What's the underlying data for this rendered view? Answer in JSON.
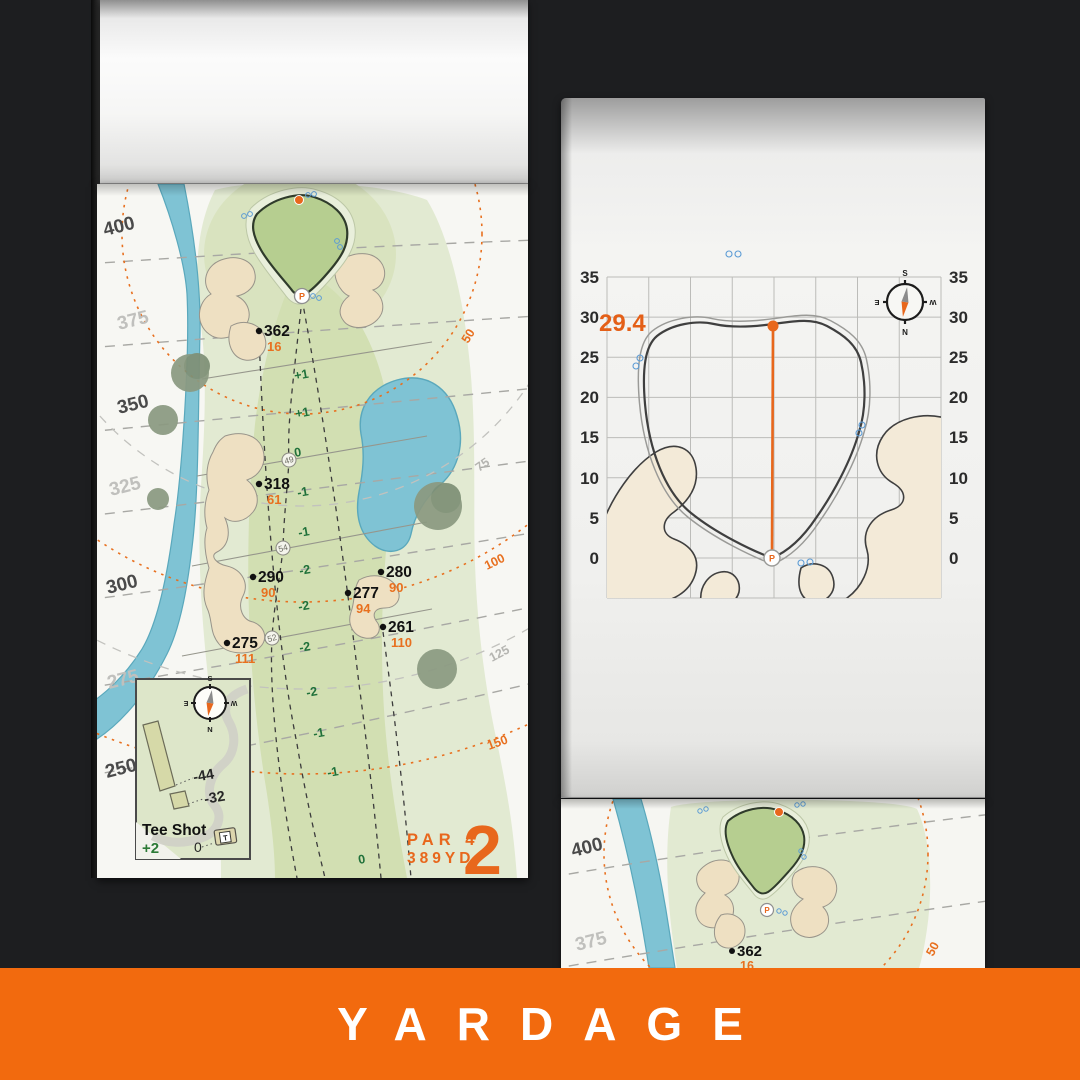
{
  "banner": {
    "label": "YARDAGE"
  },
  "colors": {
    "accent_orange": "#e8671c",
    "banner_orange": "#f26a0e",
    "water_blue": "#7fc3d4",
    "putting_green": "#b6ce90",
    "fairway_green": "#d2dfb2",
    "bunker_sand": "#eee0c2",
    "slope_green": "#20713a"
  },
  "left_page": {
    "hole_number": "2",
    "par_label": "PAR 4",
    "yardage_label": "389YD",
    "pin_label": "P",
    "distance_labels": [
      {
        "text": "400",
        "tone": "dark"
      },
      {
        "text": "375",
        "tone": "light"
      },
      {
        "text": "350",
        "tone": "dark"
      },
      {
        "text": "325",
        "tone": "light"
      },
      {
        "text": "300",
        "tone": "dark"
      },
      {
        "text": "275",
        "tone": "light"
      },
      {
        "text": "250",
        "tone": "dark"
      }
    ],
    "arc_labels": [
      {
        "text": "50",
        "tone": "orange"
      },
      {
        "text": "75",
        "tone": "gray"
      },
      {
        "text": "100",
        "tone": "orange"
      },
      {
        "text": "125",
        "tone": "gray"
      },
      {
        "text": "150",
        "tone": "orange"
      }
    ],
    "markers": [
      {
        "carry": "362",
        "to_pin": "16"
      },
      {
        "carry": "318",
        "to_pin": "61"
      },
      {
        "carry": "290",
        "to_pin": "90"
      },
      {
        "carry": "275",
        "to_pin": "111"
      },
      {
        "carry": "280",
        "to_pin": "90"
      },
      {
        "carry": "277",
        "to_pin": "94"
      },
      {
        "carry": "261",
        "to_pin": "110"
      }
    ],
    "slope_numbers": [
      "+1",
      "+1",
      "0",
      "-1",
      "-1",
      "-2",
      "-2",
      "-2",
      "-2",
      "-1",
      "-1",
      "0"
    ],
    "circled_numbers": [
      "49",
      "54",
      "52"
    ],
    "compass": {
      "top": "S",
      "bottom": "N",
      "left": "E",
      "right": "W"
    },
    "tee_inset": {
      "title": "Tee Shot",
      "score": "+2",
      "origin": "0",
      "offset_long": "-44",
      "offset_short": "-32",
      "tee_marker": "T"
    }
  },
  "right_page": {
    "green_depth": "29.4",
    "pin_label": "P",
    "axis_ticks_left": [
      "35",
      "30",
      "25",
      "20",
      "15",
      "10",
      "5",
      "0"
    ],
    "axis_ticks_right": [
      "35",
      "30",
      "25",
      "20",
      "15",
      "10",
      "5",
      "0"
    ],
    "compass": {
      "top": "S",
      "bottom": "N",
      "left": "E",
      "right": "W"
    }
  },
  "preview_page": {
    "distance_labels": [
      "400",
      "375"
    ],
    "arc_label": "50",
    "marker": {
      "carry": "362",
      "to_pin": "16"
    },
    "pin_label": "P"
  }
}
